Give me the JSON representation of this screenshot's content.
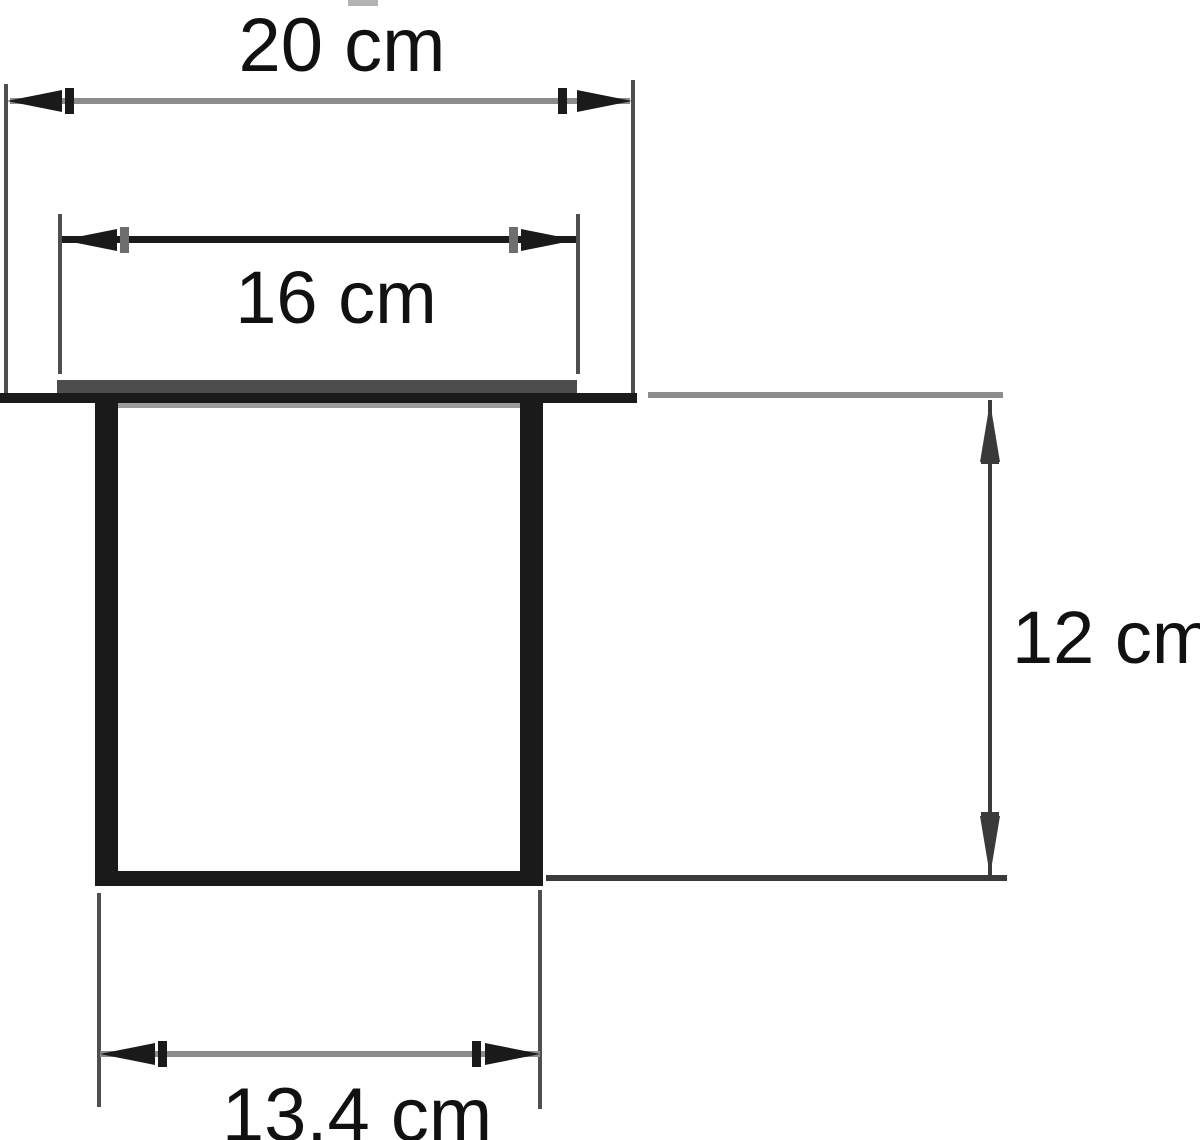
{
  "title": "Cross-section drawing of a square cup inset in a surface",
  "labels": {
    "top_width": "20 cm",
    "rim_width": "16 cm",
    "depth": "12 cm",
    "bottom_width": "13.4 cm"
  },
  "dimensions": [
    {
      "name": "top overall width",
      "value": "20 cm",
      "orientation": "horizontal"
    },
    {
      "name": "rim (flange) width",
      "value": "16 cm",
      "orientation": "horizontal"
    },
    {
      "name": "depth",
      "value": "12 cm",
      "orientation": "vertical"
    },
    {
      "name": "outer bottom width",
      "value": "13.4 cm",
      "orientation": "horizontal"
    }
  ],
  "colors": {
    "background": "#ffffff",
    "text": "#111111",
    "line_black": "#1a1a1a",
    "line_gray": "#8c8c8c",
    "line_mid": "#3a3a3a",
    "ext_line": "#4f4f4f",
    "flange": "#4d4d4d",
    "rim_inner": "#9c9c9c",
    "artifact": "#b3b3b3"
  }
}
